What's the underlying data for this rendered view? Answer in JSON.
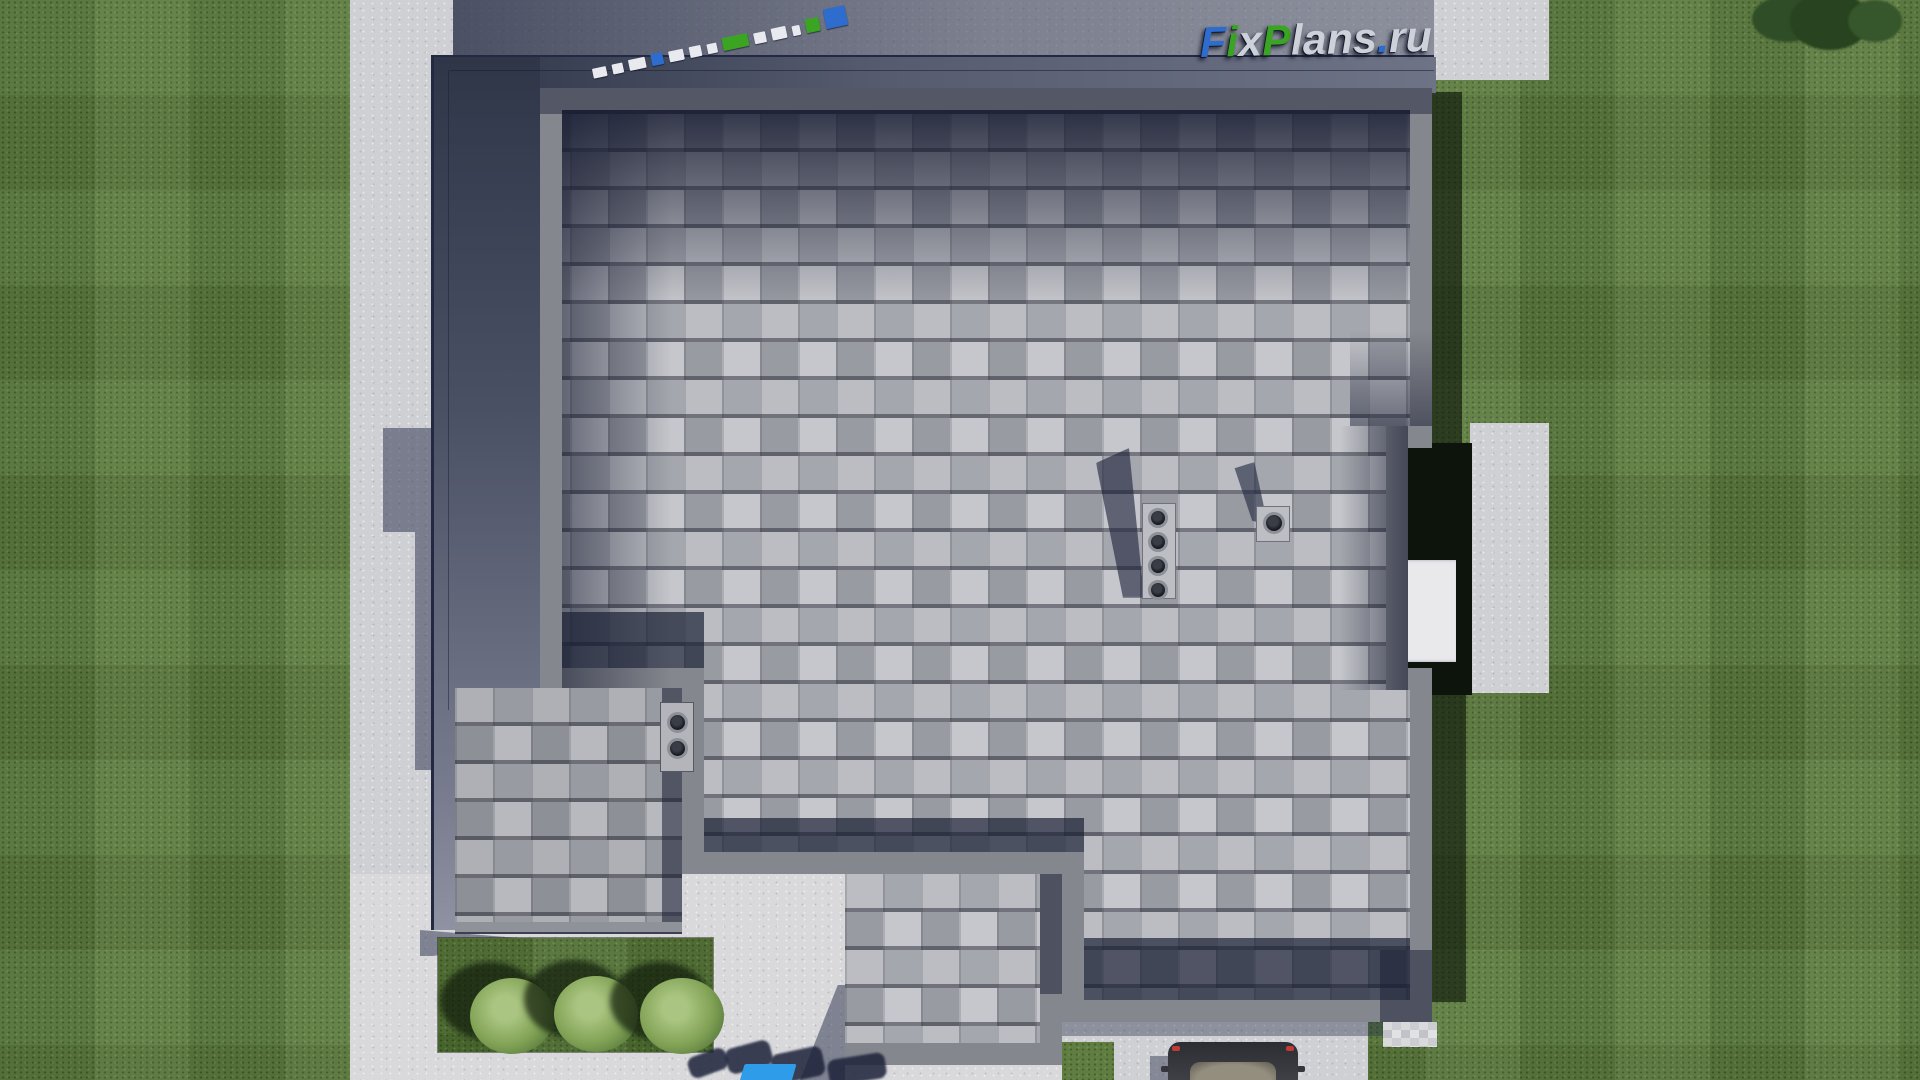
{
  "watermark": {
    "text": "FixPlans.ru",
    "letters": [
      {
        "ch": "F",
        "color": "#2e6ccd"
      },
      {
        "ch": "i",
        "color": "#3ba523"
      },
      {
        "ch": "x",
        "color": "#cdd1d9"
      },
      {
        "ch": "P",
        "color": "#3ba523"
      },
      {
        "ch": "l",
        "color": "#cdd1d9"
      },
      {
        "ch": "a",
        "color": "#cdd1d9"
      },
      {
        "ch": "n",
        "color": "#cdd1d9"
      },
      {
        "ch": "s",
        "color": "#cdd1d9"
      },
      {
        "ch": ".",
        "color": "#2e6ccd"
      },
      {
        "ch": "r",
        "color": "#cdd1d9"
      },
      {
        "ch": "u",
        "color": "#cdd1d9"
      }
    ],
    "brand_blue": "#2e6ccd",
    "brand_green": "#3ba523",
    "brand_gray": "#cdd1d9"
  },
  "standing_watermark_blocks": [
    {
      "w": 16,
      "h": 10,
      "color": "#e8eaef"
    },
    {
      "w": 14,
      "h": 10,
      "color": "#e8eaef"
    },
    {
      "w": 20,
      "h": 11,
      "color": "#e8eaef"
    },
    {
      "w": 14,
      "h": 12,
      "color": "#2e6ccd"
    },
    {
      "w": 18,
      "h": 11,
      "color": "#e8eaef"
    },
    {
      "w": 14,
      "h": 11,
      "color": "#e8eaef"
    },
    {
      "w": 12,
      "h": 10,
      "color": "#e8eaef"
    },
    {
      "w": 30,
      "h": 13,
      "color": "#3ba523"
    },
    {
      "w": 14,
      "h": 11,
      "color": "#e8eaef"
    },
    {
      "w": 18,
      "h": 12,
      "color": "#e8eaef"
    },
    {
      "w": 10,
      "h": 10,
      "color": "#e8eaef"
    },
    {
      "w": 16,
      "h": 14,
      "color": "#3ba523"
    },
    {
      "w": 26,
      "h": 20,
      "color": "#2e6ccd"
    }
  ],
  "bottom_watermark": {
    "fragment_color": "#2e9ce9",
    "shadow_color": "rgba(28,34,58,0.85)"
  },
  "scene": {
    "view": "top-down 3d render of house roof",
    "roof_shingle_base": "#b0b1b8",
    "roof_parapet": "#85878e",
    "lawn_green": "#5b7a3d",
    "concrete_gray": "#cfd0d4",
    "deck_shadow_blue": "#2f3648",
    "bush_count": 3,
    "chimney_pipe_count": 4,
    "small_vent_pipe_count": 2,
    "single_vent_pipe_count": 1,
    "car_color": "#35363b",
    "white_pad_color": "#e9e9ec"
  }
}
